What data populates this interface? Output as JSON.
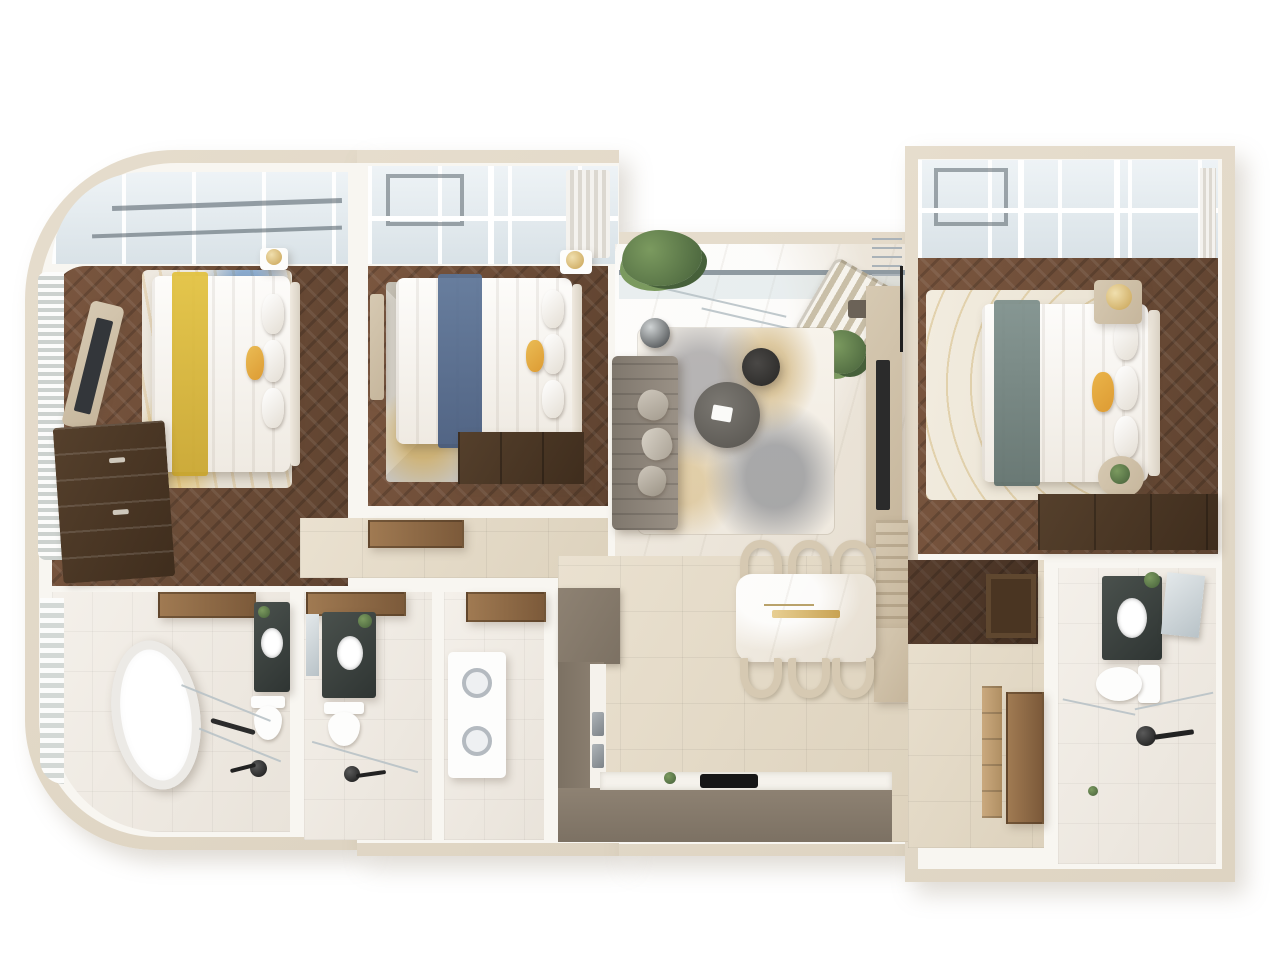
{
  "scene": {
    "type": "3d-floor-plan-render",
    "view": "top-down",
    "description": "Photorealistic top-down 3D render of a modern luxury apartment floor plan with three bedrooms, living-dining area, kitchen, three bathrooms and laundry; curved glazed facade on the left."
  },
  "palette": {
    "shell": "#e6ddcd",
    "wall": "#f8f6f1",
    "wood_a": "#7a563f",
    "wood_b": "#5f4330",
    "wood_dark_a": "#55402c",
    "wood_dark_b": "#3f2d1d",
    "tile_a": "#eae1d0",
    "tile_b": "#ddd2bd",
    "marble_a": "#f2ede4",
    "marble_b": "#e7dfd2",
    "bath_a": "#f4f0ea",
    "bath_b": "#e9e3da",
    "glass_a": "#eef3f6",
    "glass_b": "#d9e2e7",
    "frame": "#9aa6ad",
    "sofa": "#9a9186",
    "sofa_dark": "#7f776d",
    "taupe": "#8e8273",
    "taupe_dark": "#7c7163",
    "champagne": "#d6c9b2",
    "counter": "#f5f2ec",
    "gold": "#c8a253",
    "teal": "#7c8e8a",
    "blue": "#5b7396",
    "yellow": "#e2c13d",
    "orange": "#dd9b33",
    "plant_a": "#7b9a5f",
    "plant_b": "#46603a",
    "stone_a": "#4a514d",
    "stone_b": "#2f3533",
    "white_fix": "#fdfdfc",
    "black": "#222222",
    "mirror_a": "#e3e8ea",
    "mirror_b": "#b9c3c8",
    "door_a": "#a07a52",
    "door_b": "#7c5a3a",
    "railing": "#8f9aa1"
  },
  "rooms": [
    {
      "id": "bedroom-1",
      "name": "Bedroom 1 (curved facade)",
      "furniture": [
        "double bed with yellow runner",
        "art rug",
        "wall TV on curved panel",
        "tall dresser",
        "nightstand with gold lamp",
        "louvered curved window",
        "glazed bay balcony"
      ]
    },
    {
      "id": "bedroom-2",
      "name": "Bedroom 2",
      "furniture": [
        "double bed with blue runner",
        "geometric rug",
        "floating console",
        "foot-of-bed wardrobe",
        "nightstand with gold lamp",
        "picture window",
        "curtain"
      ]
    },
    {
      "id": "living-room",
      "name": "Living Room",
      "furniture": [
        "channel-tufted sofa",
        "round coffee table pair",
        "sphere floor lamp",
        "abstract marble-look rug",
        "media wall with TV",
        "striped lounge chair",
        "balcony with glass railing",
        "planters"
      ]
    },
    {
      "id": "dining-area",
      "name": "Dining Area",
      "furniture": [
        "marble dining table with gold bar",
        "six arch chairs",
        "slatted sideboard"
      ]
    },
    {
      "id": "kitchen",
      "name": "Kitchen",
      "furniture": [
        "L-shaped taupe cabinets",
        "double stainless sink",
        "induction cooktop",
        "tall cabinet block"
      ]
    },
    {
      "id": "master-bedroom",
      "name": "Master Bedroom",
      "furniture": [
        "king bed with teal runner",
        "gold-swirl rug",
        "two nightstands with lamp and plant",
        "full-width wardrobe",
        "panoramic window"
      ]
    },
    {
      "id": "master-bathroom",
      "name": "Master Bathroom",
      "furniture": [
        "stone vanity with vessel sink",
        "leaning mirror",
        "toilet",
        "walk-in shower with black fixture"
      ]
    },
    {
      "id": "bathroom-1",
      "name": "Bathroom 1",
      "furniture": [
        "freestanding oval tub",
        "stone vanity",
        "toilet",
        "shower fixture",
        "curved glazed wall"
      ]
    },
    {
      "id": "bathroom-2",
      "name": "Bathroom 2",
      "furniture": [
        "stone vanity with mirror",
        "toilet",
        "shower fixture"
      ]
    },
    {
      "id": "laundry-room",
      "name": "Laundry Room",
      "furniture": [
        "stacked washer-dryer",
        "wood door leaf"
      ]
    },
    {
      "id": "hallway",
      "name": "Hallway",
      "furniture": [
        "tiled floor",
        "open wood door"
      ]
    },
    {
      "id": "dressing-corridor",
      "name": "Dressing Corridor",
      "furniture": [
        "herringbone wardrobe block",
        "framed cabinet door",
        "shelving strip",
        "wood door"
      ]
    }
  ]
}
